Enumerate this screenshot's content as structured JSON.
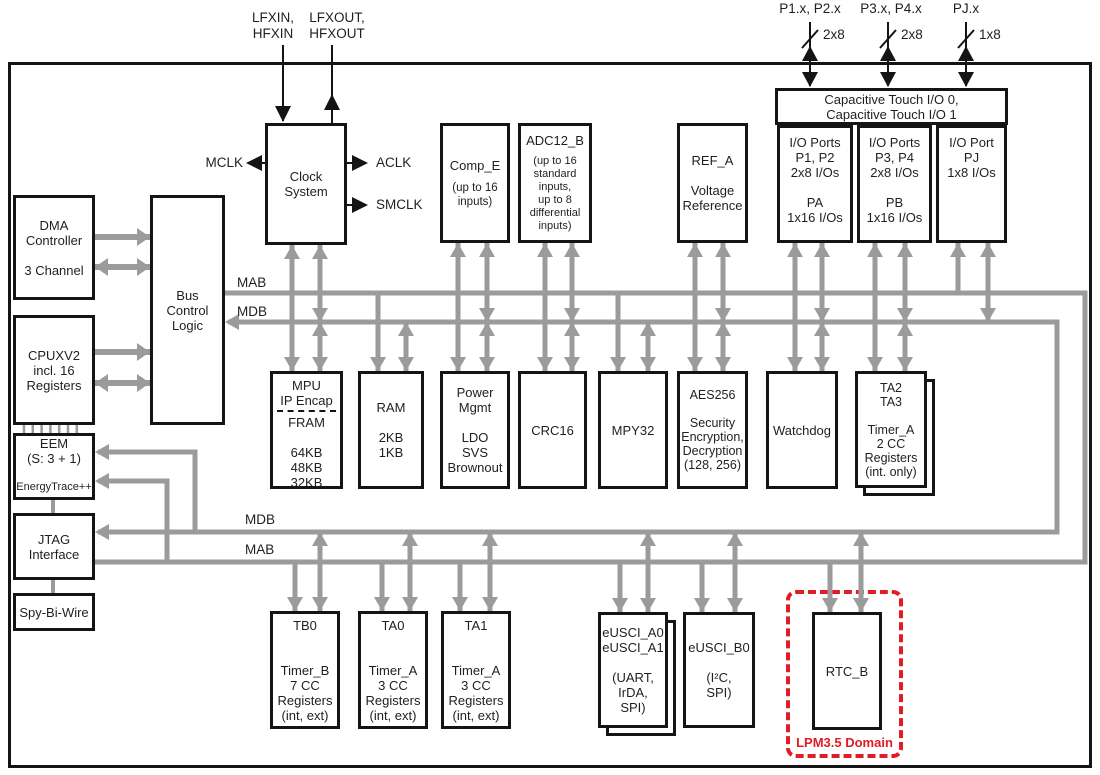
{
  "figure": "MCU functional block diagram",
  "colors": {
    "wire_gray": "#9b9b9b",
    "line_black": "#141414",
    "lpm_red": "#e31b23",
    "background": "#ffffff"
  },
  "pins": {
    "lfxin": "LFXIN,\nHFXIN",
    "lfxout": "LFXOUT,\nHFXOUT",
    "mclk": "MCLK",
    "aclk": "ACLK",
    "smclk": "SMCLK",
    "ports": [
      {
        "label": "P1.x, P2.x",
        "width": "2x8"
      },
      {
        "label": "P3.x, P4.x",
        "width": "2x8"
      },
      {
        "label": "PJ.x",
        "width": "1x8"
      }
    ]
  },
  "buses": {
    "mab_upper": "MAB",
    "mdb_upper": "MDB",
    "mdb_lower": "MDB",
    "mab_lower": "MAB"
  },
  "blocks": {
    "dma": "DMA\nController\n\n3 Channel",
    "bus_control": "Bus\nControl\nLogic",
    "cpu": "CPUXV2\nincl. 16\nRegisters",
    "eem_title": "EEM\n(S: 3 + 1)",
    "eem_sub": "EnergyTrace++",
    "jtag": "JTAG\nInterface",
    "sbw": "Spy-Bi-Wire",
    "clock": "Clock\nSystem",
    "comp_title": "Comp_E",
    "comp_sub": "(up to 16\ninputs)",
    "adc_title": "ADC12_B",
    "adc_sub": "(up to 16\nstandard\ninputs,\nup to 8\ndifferential\ninputs)",
    "ref": "REF_A\n\nVoltage\nReference",
    "captouch": "Capacitive Touch I/O 0,\nCapacitive Touch I/O 1",
    "io12": "I/O Ports\nP1, P2\n2x8 I/Os\n\nPA\n1x16 I/Os",
    "io34": "I/O Ports\nP3, P4\n2x8 I/Os\n\nPB\n1x16 I/Os",
    "iopj": "I/O Port\nPJ\n1x8 I/Os",
    "mpu_top": "MPU\nIP Encap",
    "mpu_bottom": "FRAM\n\n64KB\n48KB\n32KB",
    "ram": "RAM\n\n2KB\n1KB",
    "pmm": "Power\nMgmt\n\nLDO\nSVS\nBrownout",
    "crc": "CRC16",
    "mpy": "MPY32",
    "aes": "AES256\n\nSecurity\nEncryption,\nDecryption\n(128, 256)",
    "wdt": "Watchdog",
    "ta23": "TA2\nTA3\n\nTimer_A\n2 CC\nRegisters\n(int. only)",
    "tb0": "TB0\n\n\nTimer_B\n7 CC\nRegisters\n(int, ext)",
    "ta0": "TA0\n\n\nTimer_A\n3 CC\nRegisters\n(int, ext)",
    "ta1": "TA1\n\n\nTimer_A\n3 CC\nRegisters\n(int, ext)",
    "eusci_a": "eUSCI_A0\neUSCI_A1\n\n(UART,\nIrDA,\nSPI)",
    "eusci_b": "eUSCI_B0\n\n(I²C,\nSPI)",
    "rtc": "RTC_B"
  },
  "lpm_domain_label": "LPM3.5 Domain"
}
